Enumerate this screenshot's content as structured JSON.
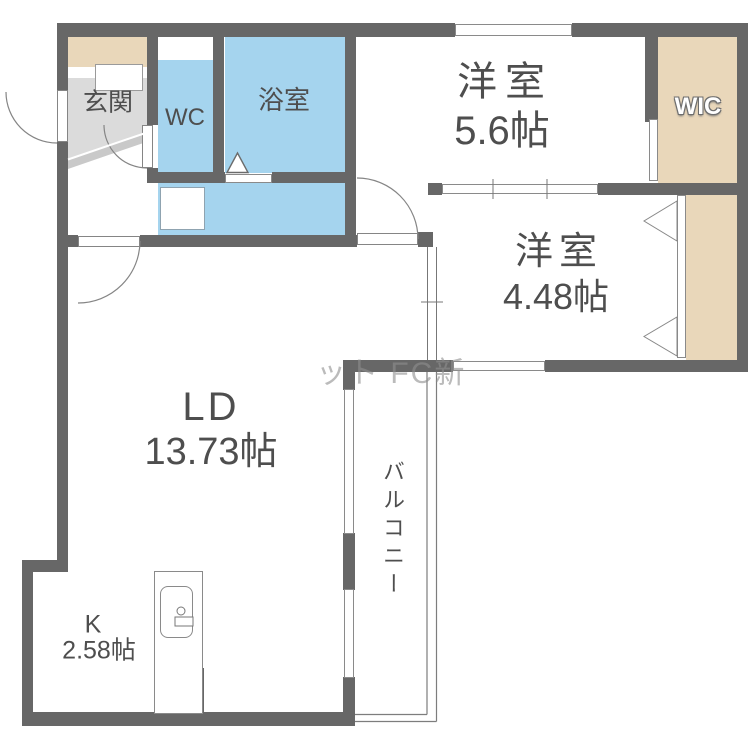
{
  "rooms": {
    "genkan": {
      "label": "玄関"
    },
    "wc": {
      "label": "WC"
    },
    "bathroom": {
      "label": "浴室"
    },
    "bedroom_upper": {
      "label": "洋室",
      "size": "5.6帖"
    },
    "wic": {
      "label": "WIC"
    },
    "bedroom_lower": {
      "label": "洋室",
      "size": "4.48帖"
    },
    "living_dining": {
      "label": "LD",
      "size": "13.73帖"
    },
    "kitchen": {
      "label": "K",
      "size": "2.58帖"
    },
    "balcony": {
      "label": "バルコニー"
    }
  },
  "watermark": {
    "text": "ット FC新"
  },
  "colors": {
    "wall": "#676767",
    "wet_area_blue": "#a5d4ee",
    "storage_beige": "#e9d7ba",
    "genkan_gray": "#dbdbdb",
    "label_text": "#4e4e4e"
  }
}
